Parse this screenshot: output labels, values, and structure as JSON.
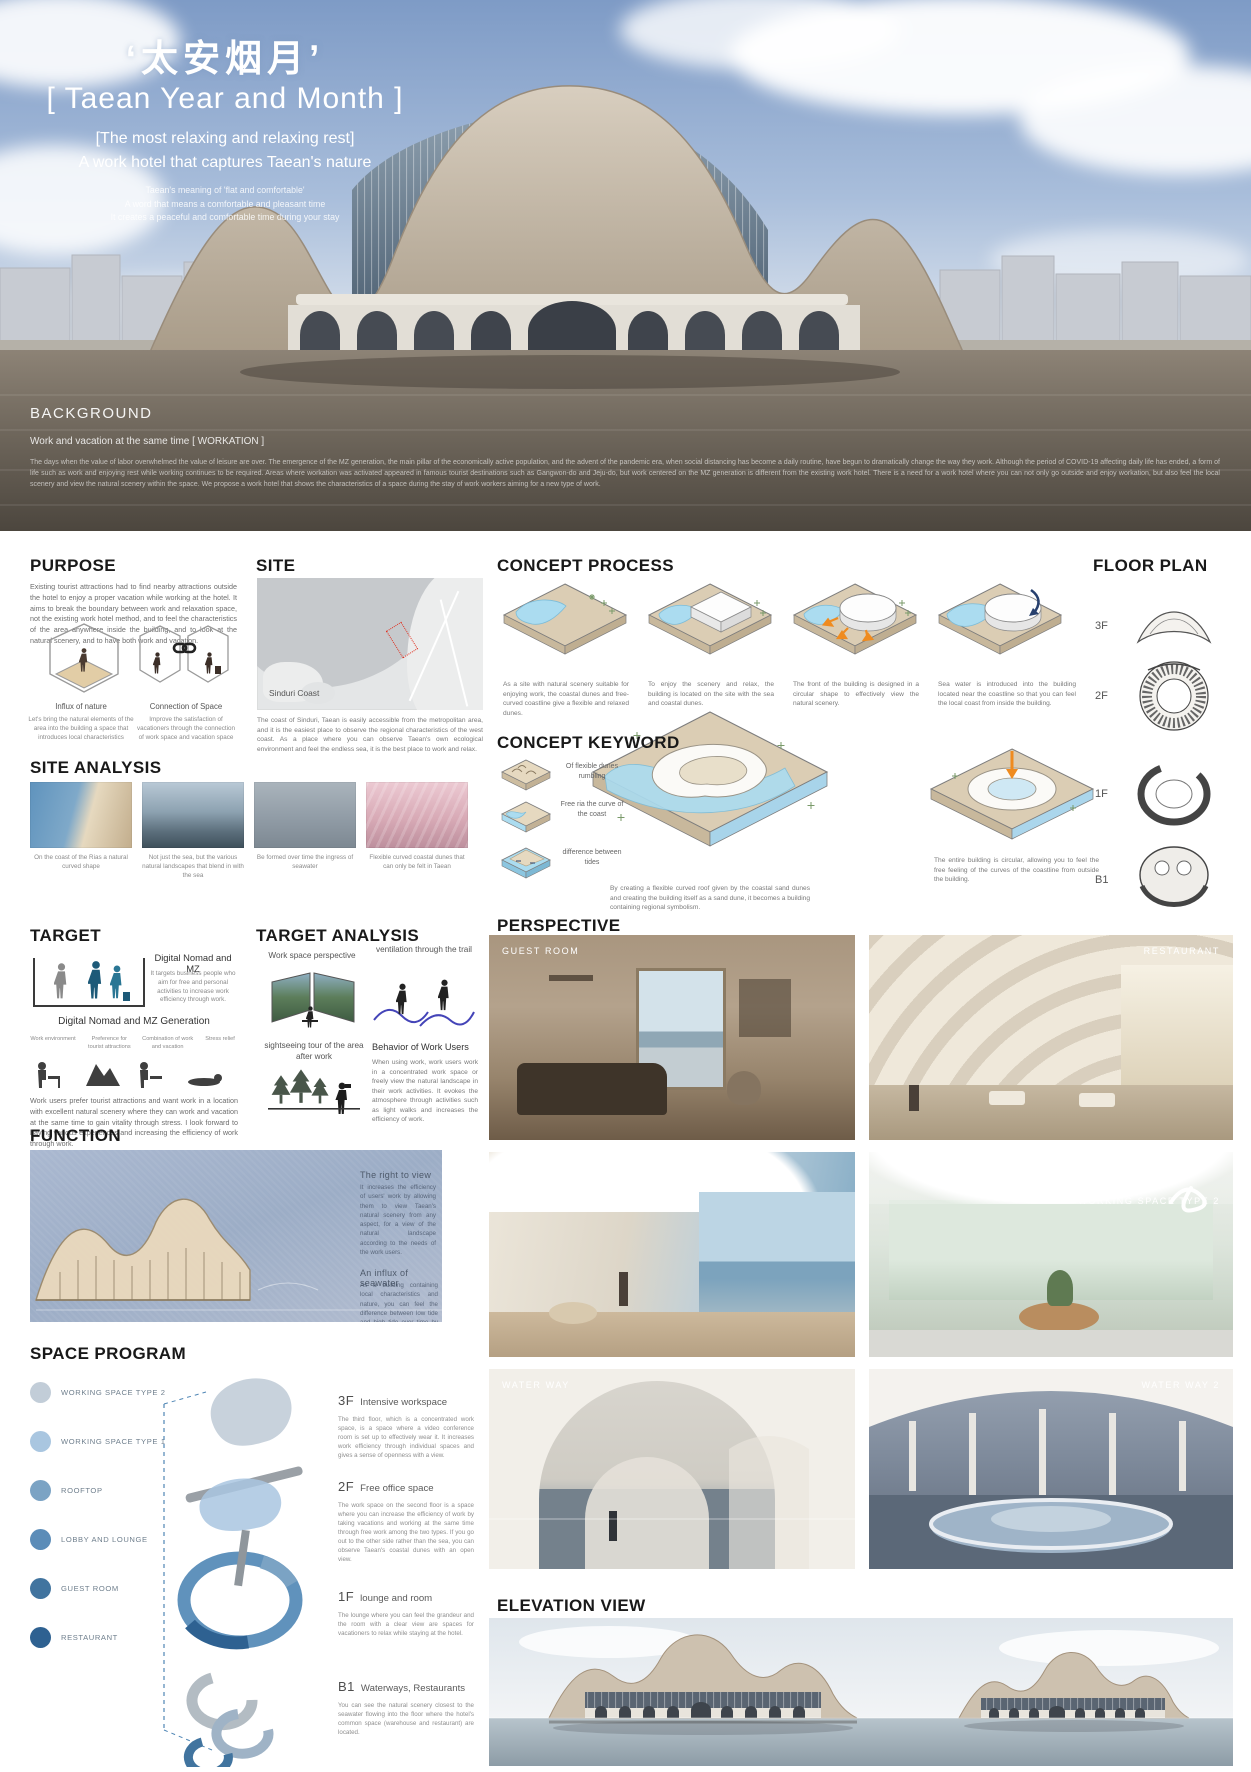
{
  "hero": {
    "title_cn": "‘太安烟月’",
    "title_en": "[ Taean Year and Month ]",
    "subtitle1": "[The most relaxing and relaxing rest]",
    "subtitle2": "A work hotel that captures Taean's nature",
    "tagline1": "Taean's meaning of 'flat and comfortable'",
    "tagline2": "A word that means a comfortable and pleasant time",
    "tagline3": "It creates a peaceful and comfortable time during your stay",
    "background": {
      "heading": "BACKGROUND",
      "subheading": "Work and vacation at the same time [ WORKATION ]",
      "body": "The days when the value of labor overwhelmed the value of leisure are over. The emergence of the MZ generation, the main pillar of the economically active population, and the advent of the pandemic era, when social distancing has become a daily routine, have begun to dramatically change the way they work. Although the period of COVID-19 affecting daily life has ended, a form of life such as work and enjoying rest while working continues to be required. Areas where workation was activated appeared in famous tourist destinations such as Gangwon-do and Jeju-do, but work centered on the MZ generation is different from the existing work hotel. There is a need for a work hotel where you can not only go outside and enjoy workation, but also feel the local scenery and view the natural scenery within the space. We propose a work hotel that shows the characteristics of a space during the stay of work workers aiming for a new type of work."
    }
  },
  "purpose": {
    "heading": "PURPOSE",
    "body": "Existing tourist attractions had to find nearby attractions outside the hotel to enjoy a proper vacation while working at the hotel. It aims to break the boundary between work and relaxation space, not the existing work hotel method, and to feel the characteristics of the area anywhere inside the building, and to look at the natural scenery, and to have both work and vacation.",
    "items": [
      {
        "title": "Influx of nature",
        "desc": "Let's bring the natural elements of the area into the building a space that introduces local characteristics"
      },
      {
        "title": "Connection of Space",
        "desc": "Improve the satisfaction of vacationers through the connection of work space and vacation space"
      }
    ]
  },
  "site": {
    "heading": "SITE",
    "map_label": "Sinduri Coast",
    "body": "The coast of Sinduri, Taean is easily accessible from the metropolitan area, and it is the easiest place to observe the regional characteristics of the west coast. As a place where you can observe Taean's own ecological environment and feel the endless sea, it is the best place to work and relax."
  },
  "concept_process": {
    "heading": "CONCEPT PROCESS",
    "steps": [
      {
        "caption": "As a site with natural scenery suitable for enjoying work, the coastal dunes and free-curved coastline give a flexible and relaxed dunes."
      },
      {
        "caption": "To enjoy the scenery and relax, the building is located on the site with the sea and coastal dunes."
      },
      {
        "caption": "The front of the building is designed in a circular shape to effectively view the natural scenery."
      },
      {
        "caption": "Sea water is introduced into the building located near the coastline so that you can feel the local coast from inside the building."
      }
    ],
    "stage1_caption": "By creating a flexible curved roof given by the coastal sand dunes and creating the building itself as a sand dune, it becomes a building containing regional symbolism.",
    "stage2_caption": "The entire building is circular, allowing you to feel the free feeling of the curves of the coastline from outside the building."
  },
  "concept_keyword": {
    "heading": "CONCEPT KEYWORD",
    "items": [
      {
        "label": "Of flexible dunes rumbling"
      },
      {
        "label": "Free ria the curve of the coast"
      },
      {
        "label": "difference between tides"
      }
    ]
  },
  "floor_plan": {
    "heading": "FLOOR PLAN",
    "levels": [
      "3F",
      "2F",
      "1F",
      "B1"
    ]
  },
  "site_analysis": {
    "heading": "SITE ANALYSIS",
    "items": [
      {
        "caption": "On the coast of the Rias a natural curved shape"
      },
      {
        "caption": "Not just the sea, but the various natural landscapes that blend in with the sea"
      },
      {
        "caption": "Be formed over time the ingress of seawater"
      },
      {
        "caption": "Flexible curved coastal dunes that can only be felt in Taean"
      }
    ]
  },
  "target": {
    "heading": "TARGET",
    "group_title": "Digital Nomad and MZ",
    "group_desc": "It targets business people who aim for free and personal activities to increase work efficiency through work.",
    "gen_title": "Digital Nomad and MZ Generation",
    "traits": [
      "Work environment",
      "Preference for tourist attractions",
      "Combination of work and vacation",
      "Stress relief"
    ],
    "body": "Work users prefer tourist attractions and want work in a location with excellent natural scenery where they can work and vacation at the same time to gain vitality through stress. I look forward to having various experiences and increasing the efficiency of work through work."
  },
  "target_analysis": {
    "heading": "TARGET ANALYSIS",
    "item1": "Work space perspective",
    "item2": "ventilation through the trail",
    "item3": "sightseeing tour of the area after work",
    "item4_title": "Behavior of Work Users",
    "item4_body": "When using work, work users work in a concentrated work space or freely view the natural landscape in their work activities. It evokes the atmosphere through activities such as light walks and increases the efficiency of work."
  },
  "function": {
    "heading": "FUNCTION",
    "callout1_title": "The right to view",
    "callout1_body": "It increases the efficiency of users' work by allowing them to view Taean's natural scenery from any aspect, for a view of the natural landscape according to the needs of the work users.",
    "callout2_title": "An influx of seawater",
    "callout2_body": "As a building containing local characteristics and nature, you can feel the difference between low tide and high tide over time by allowing seawater to flow in along the waterway into the building."
  },
  "space_program": {
    "heading": "SPACE PROGRAM",
    "legend": [
      {
        "label": "WORKING SPACE TYPE 2",
        "color": "#c2cdd8"
      },
      {
        "label": "WORKING SPACE TYPE 1",
        "color": "#a9c6e0"
      },
      {
        "label": "ROOFTOP",
        "color": "#7ba3c4"
      },
      {
        "label": "LOBBY AND LOUNGE",
        "color": "#5b8cb8"
      },
      {
        "label": "GUEST ROOM",
        "color": "#41749f"
      },
      {
        "label": "RESTAURANT",
        "color": "#2e6191"
      }
    ],
    "floors": [
      {
        "level": "3F",
        "title": "Intensive workspace",
        "body": "The third floor, which is a concentrated work space, is a space where a video conference room is set up to effectively wear it. It increases work efficiency through individual spaces and gives a sense of openness with a view."
      },
      {
        "level": "2F",
        "title": "Free office space",
        "body": "The work space on the second floor is a space where you can increase the efficiency of work by taking vacations and working at the same time through free work among the two types. If you go out to the other side rather than the sea, you can observe Taean's coastal dunes with an open view."
      },
      {
        "level": "1F",
        "title": "lounge and room",
        "body": "The lounge where you can feel the grandeur and the room with a clear view are spaces for vacationers to relax while staying at the hotel."
      },
      {
        "level": "B1",
        "title": "Waterways, Restaurants",
        "body": "You can see the natural scenery closest to the seawater flowing into the floor where the hotel's common space (warehouse and restaurant) are located."
      }
    ]
  },
  "perspective": {
    "heading": "PERSPECTIVE",
    "tiles": [
      {
        "label": "GUEST ROOM"
      },
      {
        "label": "RESTAURANT"
      },
      {
        "label": "WORKING SPACE TYPE 1"
      },
      {
        "label": "WORKING SPACE TYPE 2"
      },
      {
        "label": "WATER WAY"
      },
      {
        "label": "WATER WAY 2"
      }
    ]
  },
  "elevation": {
    "heading": "ELEVATION VIEW"
  }
}
